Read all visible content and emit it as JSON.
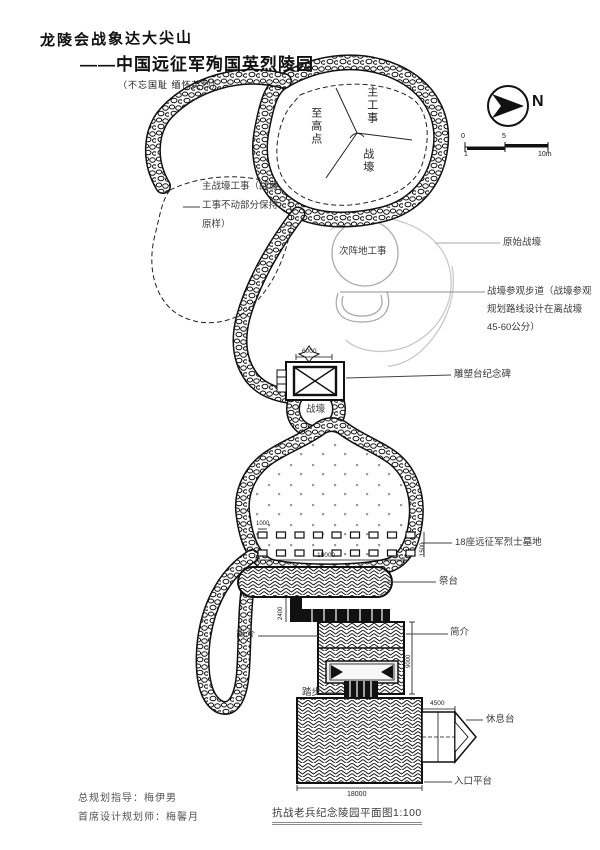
{
  "title": {
    "line1": "龙陵会战象达大尖山",
    "line2": "——中国远征军殉国英烈陵园",
    "line3": "（不忘国耻 缅怀英烈）"
  },
  "compass": {
    "north_label": "N"
  },
  "scale_bar": {
    "t0": "0",
    "t5": "5",
    "t10": "10m",
    "t1": "1"
  },
  "plan_labels": {
    "summit": "至高点",
    "main_works": "主工事",
    "trench_top": "战壕",
    "main_trench_note_l1": "主战壕工事（战壕",
    "main_trench_note_l2": "工事不动部分保持",
    "main_trench_note_l3": "原样）",
    "secondary_works": "次阵地工事",
    "original_trench": "原始战壕",
    "visit_path_l1": "战壕参观步道（战壕参观",
    "visit_path_l2": "规划路线设计在离战壕",
    "visit_path_l3": "45-60公分）",
    "sculpture_monument": "雕塑台纪念碑",
    "trench_mid": "战壕",
    "graves": "18座远征军烈士墓地",
    "altar": "祭台",
    "intro_left": "简介",
    "intro_right": "简介",
    "steps": "踏步",
    "rest_platform": "休息台",
    "entrance_platform": "入口平台"
  },
  "dimensions": {
    "monument_width": "6000",
    "grave_width": "1000",
    "grave_rows_height": "1500",
    "graves_span": "15000",
    "step_band_height": "2400",
    "intro_height": "9000",
    "rest_width": "4500",
    "entrance_width": "18000"
  },
  "credits": {
    "director": "总规划指导：梅伊男",
    "designer": "首席设计规划师：梅馨月"
  },
  "caption": "抗战老兵纪念陵园平面图1:100",
  "colors": {
    "ink": "#111111",
    "faint": "#bbbbbb",
    "label": "#3a3a3a"
  }
}
